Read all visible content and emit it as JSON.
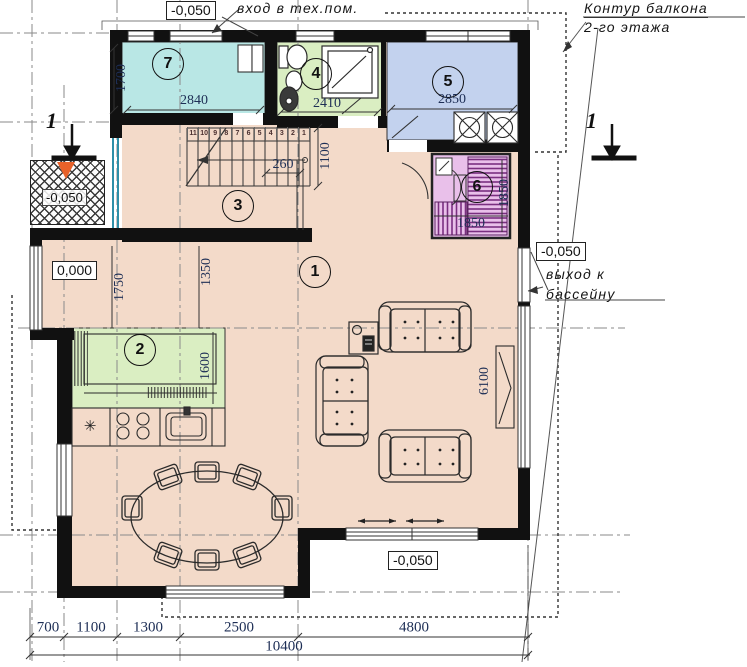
{
  "annotations": {
    "elev_top": "-0,050",
    "entry_tech": "вход в тех.пом.",
    "balcony_l1": "Контур балкона",
    "balcony_l2": "2-го этажа",
    "elev_porch": "-0,050",
    "elev_zero": "0,000",
    "elev_right": "-0,050",
    "pool_l1": "выход к",
    "pool_l2": "бассейну",
    "elev_bottom": "-0,050",
    "section_left": "1",
    "section_right": "1"
  },
  "room_numbers": [
    "1",
    "2",
    "3",
    "4",
    "5",
    "6",
    "7"
  ],
  "dims": {
    "room7_depth": "1700",
    "room7_width": "2840",
    "room4_width": "2410",
    "room5_width": "2850",
    "stair_width": "1100",
    "stair_run": "260",
    "hall_depth": "1750",
    "hall_width": "1350",
    "kitchen_depth": "1600",
    "sauna_width": "1850",
    "sauna_depth": "1850",
    "window_width": "6100",
    "bottom": [
      "700",
      "1100",
      "1300",
      "2500",
      "4800"
    ],
    "total": "10400"
  },
  "stair_treads": [
    "11",
    "10",
    "9",
    "8",
    "7",
    "6",
    "5",
    "4",
    "3",
    "2",
    "1"
  ],
  "symbols": {
    "fridge": "✳"
  },
  "colors": {
    "floor": "#f3dac9",
    "room7": "#b9e7e5",
    "room4": "#daeec2",
    "room5": "#c3d2ee",
    "room6": "#e9c0ea",
    "kitchen": "#daeec2",
    "wall": "#111111",
    "entry_arrow": "#e8622a",
    "entry_door": "#2e8fa8",
    "dim_text": "#1d2e55"
  }
}
